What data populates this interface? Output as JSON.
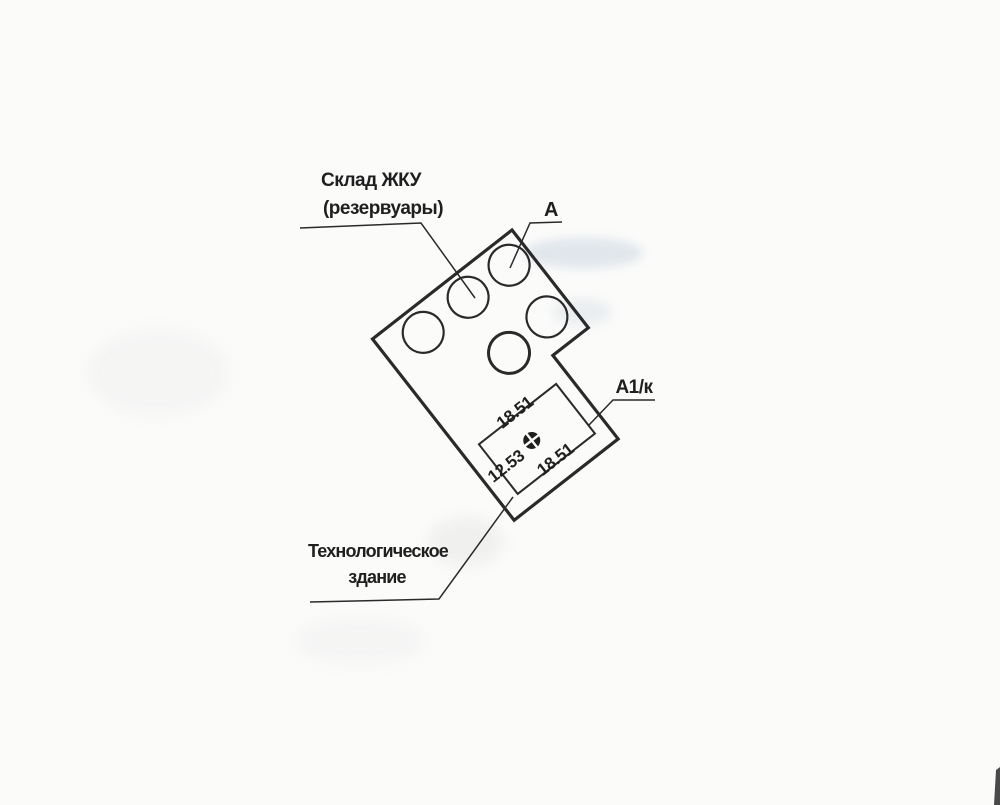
{
  "plan": {
    "labels": {
      "storage_line1": "Склад ЖКУ",
      "storage_line2": "(резервуары)",
      "section_a": "А",
      "section_a1k": "А1/к",
      "tech_line1": "Технологическое",
      "tech_line2": "здание"
    },
    "elevations": {
      "top": "18.51",
      "right": "18.51",
      "left": "12.53"
    },
    "features": {
      "reservoir_count": 5,
      "benchmark_symbol": "survey-benchmark-icon",
      "building_shape": "L-shaped outline rotated ~52deg"
    },
    "colors": {
      "ink": "#2a2a2a",
      "paper": "#fbfbfa",
      "smudge": "#c6d1dd"
    }
  }
}
